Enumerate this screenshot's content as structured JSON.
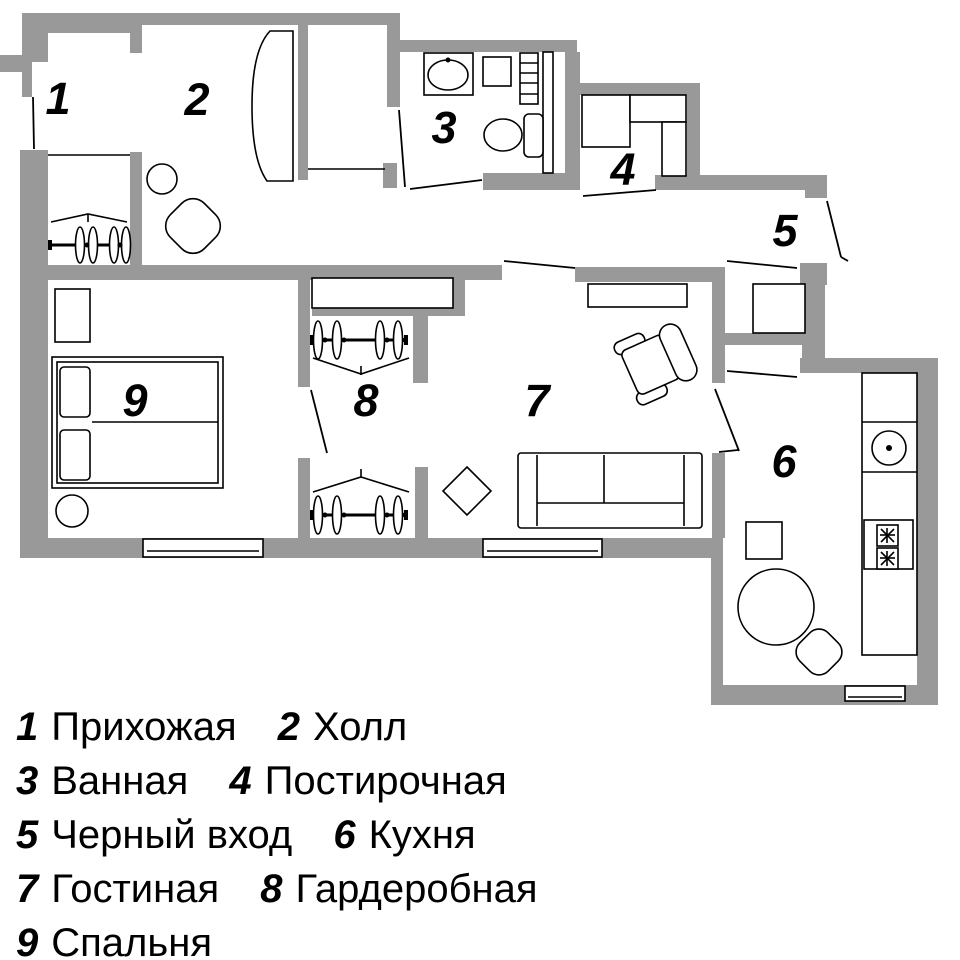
{
  "title": "Apartment floor plan with room legend",
  "colors": {
    "wall": "#999999",
    "line": "#000000",
    "background": "#ffffff"
  },
  "plan": {
    "rooms": [
      {
        "number": "1",
        "name": "Прихожая"
      },
      {
        "number": "2",
        "name": "Холл"
      },
      {
        "number": "3",
        "name": "Ванная"
      },
      {
        "number": "4",
        "name": "Постирочная"
      },
      {
        "number": "5",
        "name": "Черный вход"
      },
      {
        "number": "6",
        "name": "Кухня"
      },
      {
        "number": "7",
        "name": "Гостиная"
      },
      {
        "number": "8",
        "name": "Гардеробная"
      },
      {
        "number": "9",
        "name": "Спальня"
      }
    ]
  },
  "legend": {
    "rows": [
      {
        "items": [
          {
            "num": "1",
            "label": "Прихожая"
          },
          {
            "num": "2",
            "label": "Холл"
          }
        ]
      },
      {
        "items": [
          {
            "num": "3",
            "label": "Ванная"
          },
          {
            "num": "4",
            "label": "Постирочная"
          }
        ]
      },
      {
        "items": [
          {
            "num": "5",
            "label": "Черный вход"
          },
          {
            "num": "6",
            "label": "Кухня"
          }
        ]
      },
      {
        "items": [
          {
            "num": "7",
            "label": "Гостиная"
          },
          {
            "num": "8",
            "label": "Гардеробная"
          }
        ]
      },
      {
        "items": [
          {
            "num": "9",
            "label": "Спальня"
          }
        ]
      }
    ]
  }
}
